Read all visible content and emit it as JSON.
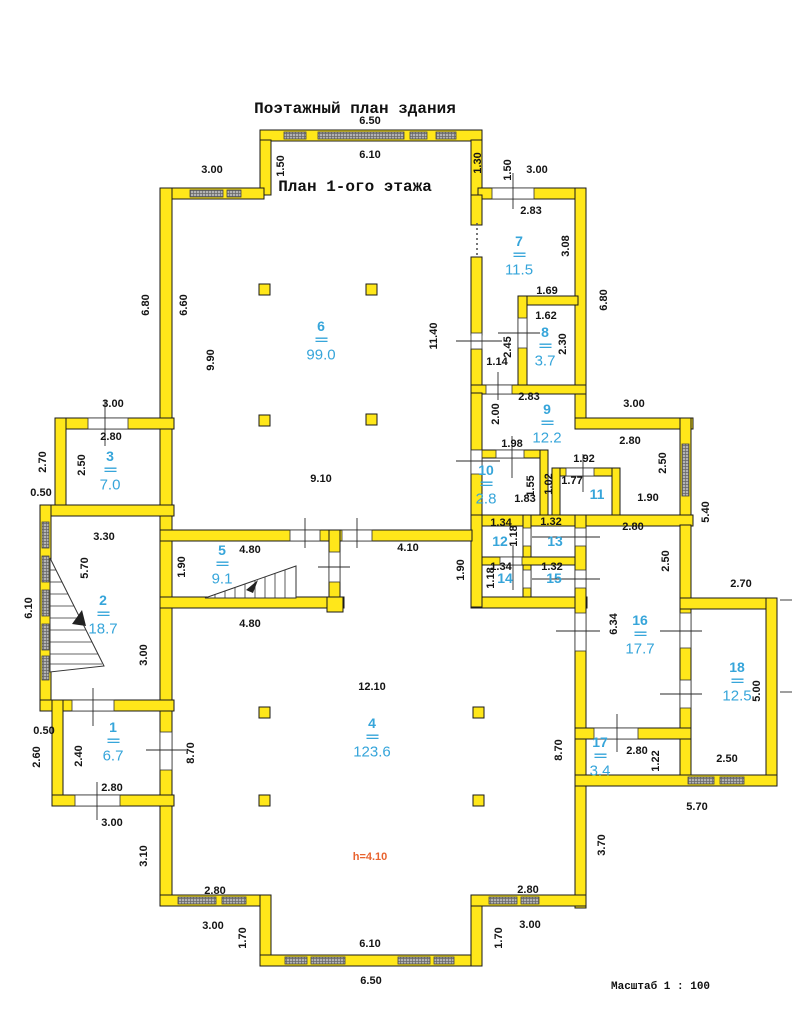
{
  "title": {
    "line1": "Поэтажный план здания",
    "line2": "План 1-ого этажа"
  },
  "notes": {
    "scale_line1": "Масштаб 1 : 100",
    "scale_line2": "Размеры в метрах",
    "ceiling_height": "h=4.10"
  },
  "colors": {
    "wall_fill": "#ffe71a",
    "wall_stroke": "#1a1a1a",
    "window_fill": "#b3b3b3",
    "window_line": "#666666",
    "opening_fill": "#ffffff",
    "tick": "#2a2a2a",
    "dim_text": "#141414",
    "room_text": "#36a5da",
    "height_text": "#e8632f",
    "column_fill": "#ffe71a"
  },
  "plan": {
    "room_divider": "==",
    "height_label_pos": [
      370,
      857
    ],
    "walls": [
      [
        260,
        130,
        222,
        11
      ],
      [
        260,
        140,
        11,
        55
      ],
      [
        471,
        140,
        11,
        55
      ],
      [
        160,
        188,
        104,
        11
      ],
      [
        478,
        188,
        108,
        11
      ],
      [
        160,
        188,
        12,
        718
      ],
      [
        575,
        188,
        11,
        240
      ],
      [
        471,
        195,
        11,
        30
      ],
      [
        471,
        257,
        11,
        78
      ],
      [
        471,
        349,
        11,
        44
      ],
      [
        518,
        296,
        60,
        9
      ],
      [
        518,
        296,
        9,
        97
      ],
      [
        471,
        385,
        115,
        9
      ],
      [
        471,
        393,
        11,
        122
      ],
      [
        575,
        418,
        118,
        11
      ],
      [
        680,
        418,
        11,
        117
      ],
      [
        471,
        450,
        77,
        8
      ],
      [
        540,
        450,
        8,
        73
      ],
      [
        552,
        468,
        68,
        8
      ],
      [
        552,
        468,
        8,
        55
      ],
      [
        612,
        468,
        8,
        55
      ],
      [
        471,
        515,
        222,
        11
      ],
      [
        523,
        515,
        8,
        91
      ],
      [
        471,
        557,
        115,
        8
      ],
      [
        471,
        597,
        116,
        11
      ],
      [
        471,
        515,
        11,
        92
      ],
      [
        575,
        515,
        11,
        393
      ],
      [
        160,
        530,
        312,
        11
      ],
      [
        329,
        530,
        11,
        76
      ],
      [
        160,
        597,
        184,
        11
      ],
      [
        327,
        597,
        16,
        15
      ],
      [
        55,
        418,
        119,
        11
      ],
      [
        55,
        418,
        11,
        98
      ],
      [
        40,
        505,
        134,
        11
      ],
      [
        40,
        505,
        11,
        206
      ],
      [
        40,
        700,
        134,
        11
      ],
      [
        52,
        700,
        11,
        106
      ],
      [
        52,
        795,
        122,
        11
      ],
      [
        680,
        525,
        11,
        260
      ],
      [
        680,
        598,
        97,
        11
      ],
      [
        766,
        598,
        11,
        188
      ],
      [
        575,
        775,
        202,
        11
      ],
      [
        575,
        728,
        116,
        11
      ],
      [
        160,
        895,
        111,
        11
      ],
      [
        260,
        895,
        11,
        71
      ],
      [
        260,
        955,
        222,
        11
      ],
      [
        471,
        895,
        11,
        71
      ],
      [
        471,
        895,
        115,
        11
      ]
    ],
    "windows": [
      [
        284,
        132,
        22,
        7
      ],
      [
        318,
        132,
        86,
        7
      ],
      [
        410,
        132,
        17,
        7
      ],
      [
        436,
        132,
        20,
        7
      ],
      [
        190,
        190,
        33,
        7
      ],
      [
        227,
        190,
        14,
        7
      ],
      [
        42,
        522,
        7,
        26
      ],
      [
        42,
        556,
        7,
        26
      ],
      [
        42,
        590,
        7,
        26
      ],
      [
        42,
        624,
        7,
        26
      ],
      [
        42,
        656,
        7,
        24
      ],
      [
        682,
        444,
        7,
        52
      ],
      [
        688,
        777,
        26,
        7
      ],
      [
        720,
        777,
        24,
        7
      ],
      [
        178,
        897,
        38,
        7
      ],
      [
        222,
        897,
        24,
        7
      ],
      [
        285,
        957,
        22,
        7
      ],
      [
        311,
        957,
        34,
        7
      ],
      [
        398,
        957,
        32,
        7
      ],
      [
        434,
        957,
        20,
        7
      ],
      [
        489,
        897,
        28,
        7
      ],
      [
        521,
        897,
        18,
        7
      ]
    ],
    "openings": [
      [
        492,
        188,
        42,
        11
      ],
      [
        88,
        418,
        40,
        11
      ],
      [
        72,
        700,
        42,
        11
      ],
      [
        75,
        795,
        45,
        11
      ],
      [
        160,
        732,
        12,
        38
      ],
      [
        290,
        530,
        30,
        11
      ],
      [
        342,
        530,
        30,
        11
      ],
      [
        329,
        552,
        11,
        30
      ],
      [
        486,
        385,
        26,
        9
      ],
      [
        518,
        318,
        9,
        30
      ],
      [
        471,
        333,
        11,
        16
      ],
      [
        471,
        450,
        11,
        24
      ],
      [
        496,
        450,
        28,
        8
      ],
      [
        566,
        468,
        28,
        8
      ],
      [
        575,
        528,
        11,
        18
      ],
      [
        575,
        570,
        11,
        18
      ],
      [
        523,
        528,
        8,
        18
      ],
      [
        523,
        570,
        8,
        18
      ],
      [
        500,
        557,
        22,
        8
      ],
      [
        575,
        613,
        11,
        38
      ],
      [
        680,
        613,
        11,
        35
      ],
      [
        680,
        680,
        11,
        28
      ],
      [
        594,
        728,
        44,
        11
      ]
    ],
    "ticks": [
      [
        513,
        173,
        513,
        209
      ],
      [
        105,
        400,
        105,
        446
      ],
      [
        93,
        688,
        93,
        726
      ],
      [
        97,
        782,
        97,
        820
      ],
      [
        146,
        750,
        186,
        750
      ],
      [
        305,
        518,
        305,
        548
      ],
      [
        357,
        518,
        357,
        548
      ],
      [
        318,
        567,
        350,
        567
      ],
      [
        498,
        372,
        498,
        400
      ],
      [
        498,
        333,
        540,
        333
      ],
      [
        456,
        461,
        500,
        461
      ],
      [
        456,
        341,
        502,
        341
      ],
      [
        512,
        436,
        512,
        478
      ],
      [
        583,
        454,
        583,
        492
      ],
      [
        532,
        537,
        600,
        537
      ],
      [
        532,
        579,
        600,
        579
      ],
      [
        513,
        545,
        513,
        590
      ],
      [
        556,
        631,
        600,
        631
      ],
      [
        660,
        631,
        702,
        631
      ],
      [
        660,
        694,
        702,
        694
      ],
      [
        617,
        714,
        617,
        752
      ],
      [
        780,
        600,
        792,
        600
      ],
      [
        780,
        692,
        792,
        692
      ]
    ],
    "dashes": [
      [
        477,
        223,
        477,
        257
      ]
    ],
    "columns": [
      [
        259,
        284
      ],
      [
        366,
        284
      ],
      [
        259,
        415
      ],
      [
        366,
        414
      ],
      [
        259,
        707
      ],
      [
        473,
        707
      ],
      [
        259,
        795
      ],
      [
        473,
        795
      ]
    ],
    "stairs": [
      {
        "outline": [
          [
            50,
            558
          ],
          [
            50,
            672
          ],
          [
            104,
            666
          ]
        ],
        "treads": [
          [
            50,
            570,
            56,
            570
          ],
          [
            50,
            582,
            62,
            582
          ],
          [
            50,
            594,
            68,
            594
          ],
          [
            50,
            606,
            74,
            606
          ],
          [
            50,
            618,
            80,
            618
          ],
          [
            50,
            630,
            86,
            630
          ],
          [
            50,
            642,
            92,
            642
          ],
          [
            50,
            654,
            98,
            654
          ],
          [
            50,
            664,
            102,
            664
          ]
        ],
        "arrow": [
          [
            72,
            624
          ],
          [
            82,
            610
          ],
          [
            86,
            626
          ]
        ]
      },
      {
        "outline": [
          [
            205,
            598
          ],
          [
            296,
            566
          ],
          [
            296,
            598
          ]
        ],
        "treads": [
          [
            215,
            598,
            215,
            594
          ],
          [
            225,
            598,
            225,
            591
          ],
          [
            235,
            598,
            235,
            587
          ],
          [
            245,
            598,
            245,
            584
          ],
          [
            255,
            598,
            255,
            580
          ],
          [
            265,
            598,
            265,
            577
          ],
          [
            275,
            598,
            275,
            573
          ],
          [
            285,
            598,
            285,
            570
          ]
        ],
        "arrow": [
          [
            246,
            590
          ],
          [
            258,
            580
          ],
          [
            253,
            593
          ]
        ]
      }
    ],
    "dims": [
      [
        "6.50",
        370,
        121,
        0
      ],
      [
        "6.10",
        370,
        155,
        0
      ],
      [
        "3.00",
        212,
        170,
        0
      ],
      [
        "1.50",
        281,
        166,
        1
      ],
      [
        "1.30",
        478,
        163,
        1
      ],
      [
        "1.50",
        508,
        170,
        1
      ],
      [
        "3.00",
        537,
        170,
        0
      ],
      [
        "2.83",
        531,
        211,
        0
      ],
      [
        "3.08",
        566,
        246,
        1
      ],
      [
        "6.80",
        604,
        300,
        1
      ],
      [
        "1.69",
        547,
        291,
        0
      ],
      [
        "1.62",
        546,
        316,
        0
      ],
      [
        "2.45",
        508,
        347,
        1
      ],
      [
        "2.30",
        563,
        344,
        1
      ],
      [
        "1.14",
        497,
        362,
        0
      ],
      [
        "2.83",
        529,
        397,
        0
      ],
      [
        "6.80",
        146,
        305,
        1
      ],
      [
        "6.60",
        184,
        305,
        1
      ],
      [
        "9.90",
        211,
        360,
        1
      ],
      [
        "11.40",
        434,
        336,
        1
      ],
      [
        "9.10",
        321,
        479,
        0
      ],
      [
        "3.00",
        634,
        404,
        0
      ],
      [
        "2.80",
        630,
        441,
        0
      ],
      [
        "2.50",
        663,
        463,
        1
      ],
      [
        "1.90",
        648,
        498,
        0
      ],
      [
        "5.40",
        706,
        512,
        1
      ],
      [
        "2.00",
        496,
        414,
        1
      ],
      [
        "1.98",
        512,
        444,
        0
      ],
      [
        "1.92",
        584,
        459,
        0
      ],
      [
        "1.55",
        531,
        486,
        1
      ],
      [
        "1.83",
        525,
        499,
        0
      ],
      [
        "1.02",
        549,
        484,
        1
      ],
      [
        "1.77",
        572,
        481,
        0
      ],
      [
        "3.00",
        113,
        404,
        0
      ],
      [
        "2.80",
        111,
        437,
        0
      ],
      [
        "2.70",
        43,
        462,
        1
      ],
      [
        "2.50",
        82,
        465,
        1
      ],
      [
        "0.50",
        41,
        493,
        0
      ],
      [
        "3.30",
        104,
        537,
        0
      ],
      [
        "5.70",
        85,
        568,
        1
      ],
      [
        "6.10",
        29,
        608,
        1
      ],
      [
        "1.90",
        182,
        567,
        1
      ],
      [
        "3.00",
        144,
        655,
        1
      ],
      [
        "4.80",
        250,
        550,
        0
      ],
      [
        "4.10",
        408,
        548,
        0
      ],
      [
        "1.90",
        461,
        570,
        1
      ],
      [
        "4.80",
        250,
        624,
        0
      ],
      [
        "1.34",
        501,
        523,
        0
      ],
      [
        "1.32",
        551,
        522,
        0
      ],
      [
        "1.18",
        514,
        536,
        1
      ],
      [
        "2.80",
        633,
        527,
        0
      ],
      [
        "2.50",
        666,
        561,
        1
      ],
      [
        "1.34",
        501,
        567,
        0
      ],
      [
        "1.32",
        552,
        567,
        0
      ],
      [
        "1.18",
        491,
        578,
        1
      ],
      [
        "6.34",
        614,
        624,
        1
      ],
      [
        "2.70",
        741,
        584,
        0
      ],
      [
        "5.00",
        757,
        691,
        1
      ],
      [
        "2.50",
        727,
        759,
        0
      ],
      [
        "5.70",
        697,
        807,
        0
      ],
      [
        "2.80",
        637,
        751,
        0
      ],
      [
        "1.22",
        656,
        761,
        1
      ],
      [
        "8.70",
        559,
        750,
        1
      ],
      [
        "3.70",
        602,
        845,
        1
      ],
      [
        "12.10",
        372,
        687,
        0
      ],
      [
        "0.50",
        44,
        731,
        0
      ],
      [
        "2.60",
        37,
        757,
        1
      ],
      [
        "2.40",
        79,
        756,
        1
      ],
      [
        "2.80",
        112,
        788,
        0
      ],
      [
        "3.00",
        112,
        823,
        0
      ],
      [
        "8.70",
        191,
        753,
        1
      ],
      [
        "3.10",
        144,
        856,
        1
      ],
      [
        "2.80",
        215,
        891,
        0
      ],
      [
        "3.00",
        213,
        926,
        0
      ],
      [
        "1.70",
        243,
        938,
        1
      ],
      [
        "6.10",
        370,
        944,
        0
      ],
      [
        "6.50",
        371,
        981,
        0
      ],
      [
        "1.70",
        499,
        938,
        1
      ],
      [
        "2.80",
        528,
        890,
        0
      ],
      [
        "3.00",
        530,
        925,
        0
      ]
    ],
    "rooms": [
      {
        "n": "1",
        "a": "6.7",
        "x": 113,
        "y": 727
      },
      {
        "n": "2",
        "a": "18.7",
        "x": 103,
        "y": 600
      },
      {
        "n": "3",
        "a": "7.0",
        "x": 110,
        "y": 456
      },
      {
        "n": "4",
        "a": "123.6",
        "x": 372,
        "y": 723
      },
      {
        "n": "5",
        "a": "9.1",
        "x": 222,
        "y": 550
      },
      {
        "n": "6",
        "a": "99.0",
        "x": 321,
        "y": 326
      },
      {
        "n": "7",
        "a": "11.5",
        "x": 519,
        "y": 241
      },
      {
        "n": "8",
        "a": "3.7",
        "x": 545,
        "y": 332
      },
      {
        "n": "9",
        "a": "12.2",
        "x": 547,
        "y": 409
      },
      {
        "n": "10",
        "a": "2.8",
        "x": 486,
        "y": 470
      },
      {
        "n": "11",
        "a": "",
        "x": 597,
        "y": 494
      },
      {
        "n": "12",
        "a": "",
        "x": 500,
        "y": 541
      },
      {
        "n": "13",
        "a": "",
        "x": 555,
        "y": 541
      },
      {
        "n": "14",
        "a": "",
        "x": 505,
        "y": 578
      },
      {
        "n": "15",
        "a": "",
        "x": 554,
        "y": 578
      },
      {
        "n": "16",
        "a": "17.7",
        "x": 640,
        "y": 620
      },
      {
        "n": "17",
        "a": "3.4",
        "x": 600,
        "y": 742
      },
      {
        "n": "18",
        "a": "12.5",
        "x": 737,
        "y": 667
      }
    ]
  }
}
